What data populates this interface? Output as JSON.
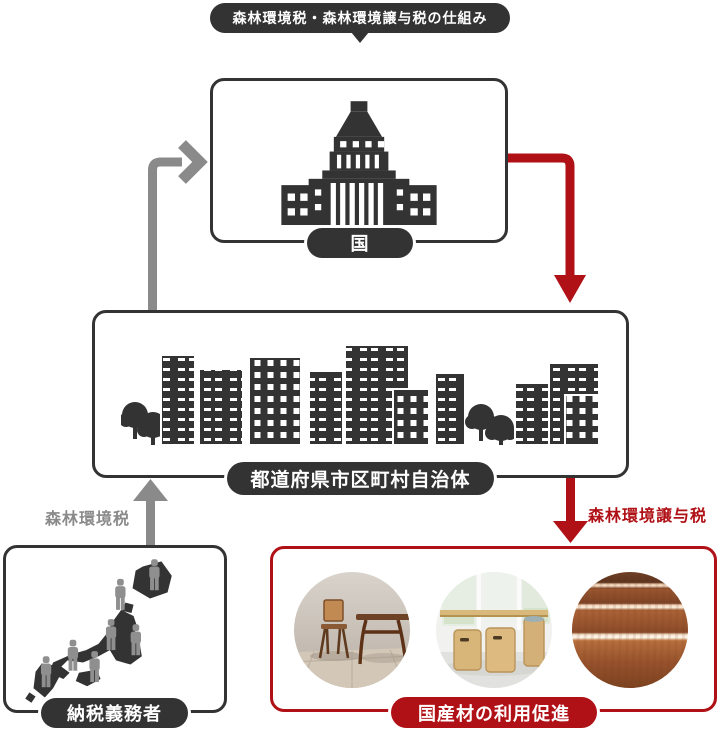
{
  "title_badge": {
    "text": "森林環境税・森林環境譲与税の仕組み"
  },
  "nodes": {
    "national": {
      "label": "国",
      "icon": "national-diet-building-icon"
    },
    "municipal": {
      "label": "都道府県市区町村自治体",
      "icon": "cityscape-icon"
    },
    "taxpayer": {
      "label": "納税義務者",
      "icon": "japan-map-people-icon"
    },
    "promotion": {
      "label": "国産材の利用促進",
      "photos": [
        {
          "name": "wooden-chair-and-desk-photo"
        },
        {
          "name": "wooden-stools-photo"
        },
        {
          "name": "wood-grain-steps-photo"
        }
      ]
    }
  },
  "flows": {
    "taxpayer_to_municipal": {
      "label": "森林環境税",
      "color": "#8a8a8a",
      "direction": "up"
    },
    "municipal_to_national": {
      "label": "",
      "color": "#8a8a8a",
      "direction": "up-then-right"
    },
    "national_to_municipal": {
      "label": "",
      "color": "#b01116",
      "direction": "right-then-down"
    },
    "municipal_to_promotion": {
      "label": "森林環境譲与税",
      "color": "#b01116",
      "direction": "down"
    }
  },
  "colors": {
    "dark": "#333333",
    "gray": "#8a8a8a",
    "red": "#b01116"
  }
}
